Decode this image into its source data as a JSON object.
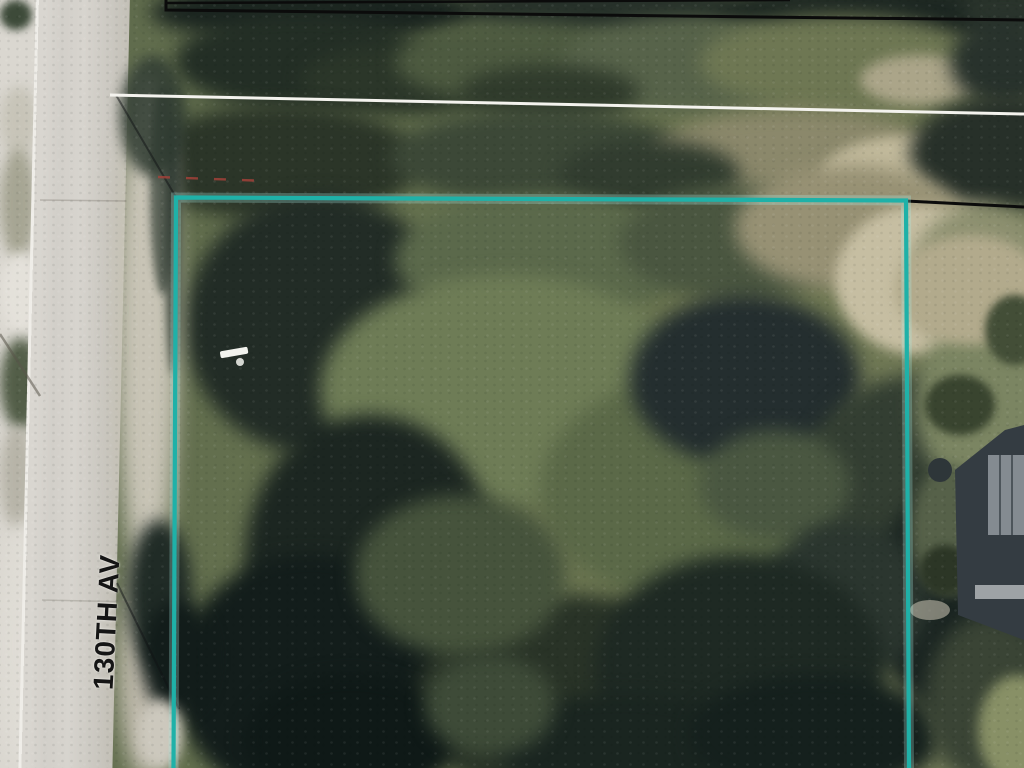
{
  "map": {
    "street_label": "130TH AV",
    "colors": {
      "parcel_highlight_teal": "#1fb1a8",
      "boundary_black": "#0b0b0b",
      "right_of_way_white": "#f4f3ee",
      "annotation_red": "#a8423a",
      "road_gray": "#d2cfc9",
      "label_black": "#151515"
    }
  }
}
